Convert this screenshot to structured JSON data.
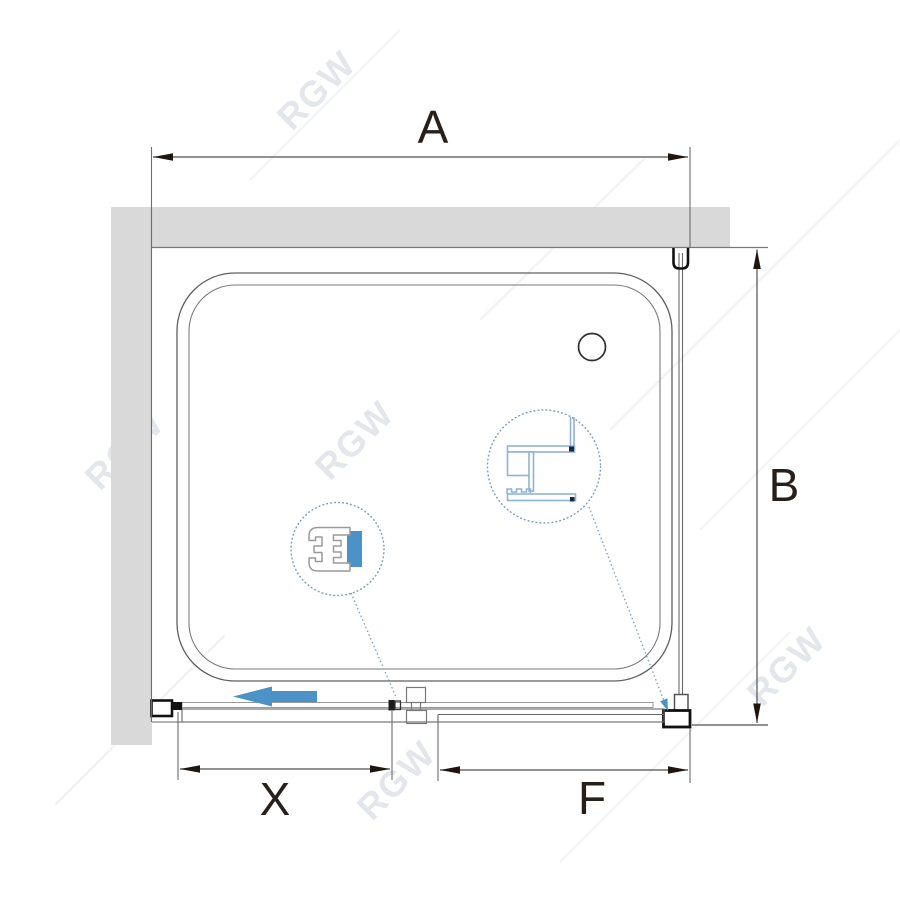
{
  "title": "Shower enclosure technical drawing (top view)",
  "watermark": {
    "text": "RGW"
  },
  "dimensions": {
    "total_width": {
      "label": "A"
    },
    "depth": {
      "label": "B"
    },
    "door_opening": {
      "label": "X"
    },
    "fixed_segment": {
      "label": "F"
    }
  },
  "colors": {
    "wall_fill": "#d9d9d9",
    "line_dark": "#4f4f4f",
    "line_black": "#111111",
    "dim_text": "#27201a",
    "arrow_fill": "#1d150e",
    "accent_blue": "#4b93c6",
    "callout_blue": "#7d9bbf",
    "profile_blue": "#8fb3d6",
    "watermark_gray": "#dfe3e8"
  }
}
